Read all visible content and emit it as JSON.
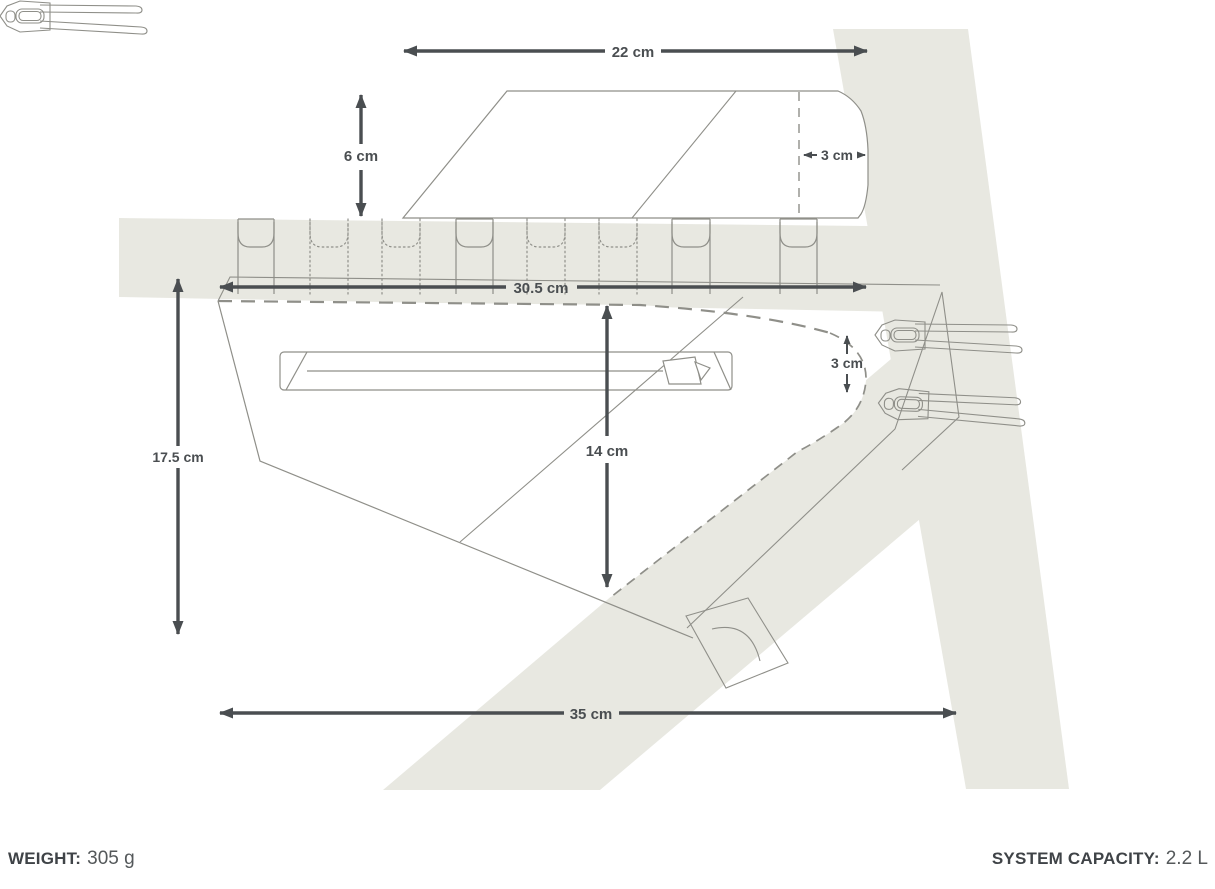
{
  "diagram": {
    "type": "product-dimension-diagram",
    "subject": "Frame bag and top tube bag mounted on a bicycle frame",
    "dimensions": {
      "top_bag_length": "22 cm",
      "top_bag_height": "6 cm",
      "top_bag_depth": "3 cm",
      "frame_bag_top_length": "30.5 cm",
      "frame_bag_mid_height": "14 cm",
      "frame_bag_rear_depth": "3 cm",
      "frame_bag_front_height": "17.5 cm",
      "frame_bag_bottom_length": "35 cm"
    },
    "colors": {
      "frame_fill": "#e8e8e1",
      "outline": "#8f8f89",
      "dimension": "#4a4e51",
      "background": "#ffffff"
    }
  },
  "footer": {
    "weight_label": "WEIGHT:",
    "weight_value": "305 g",
    "capacity_label": "SYSTEM CAPACITY:",
    "capacity_value": "2.2 L"
  }
}
